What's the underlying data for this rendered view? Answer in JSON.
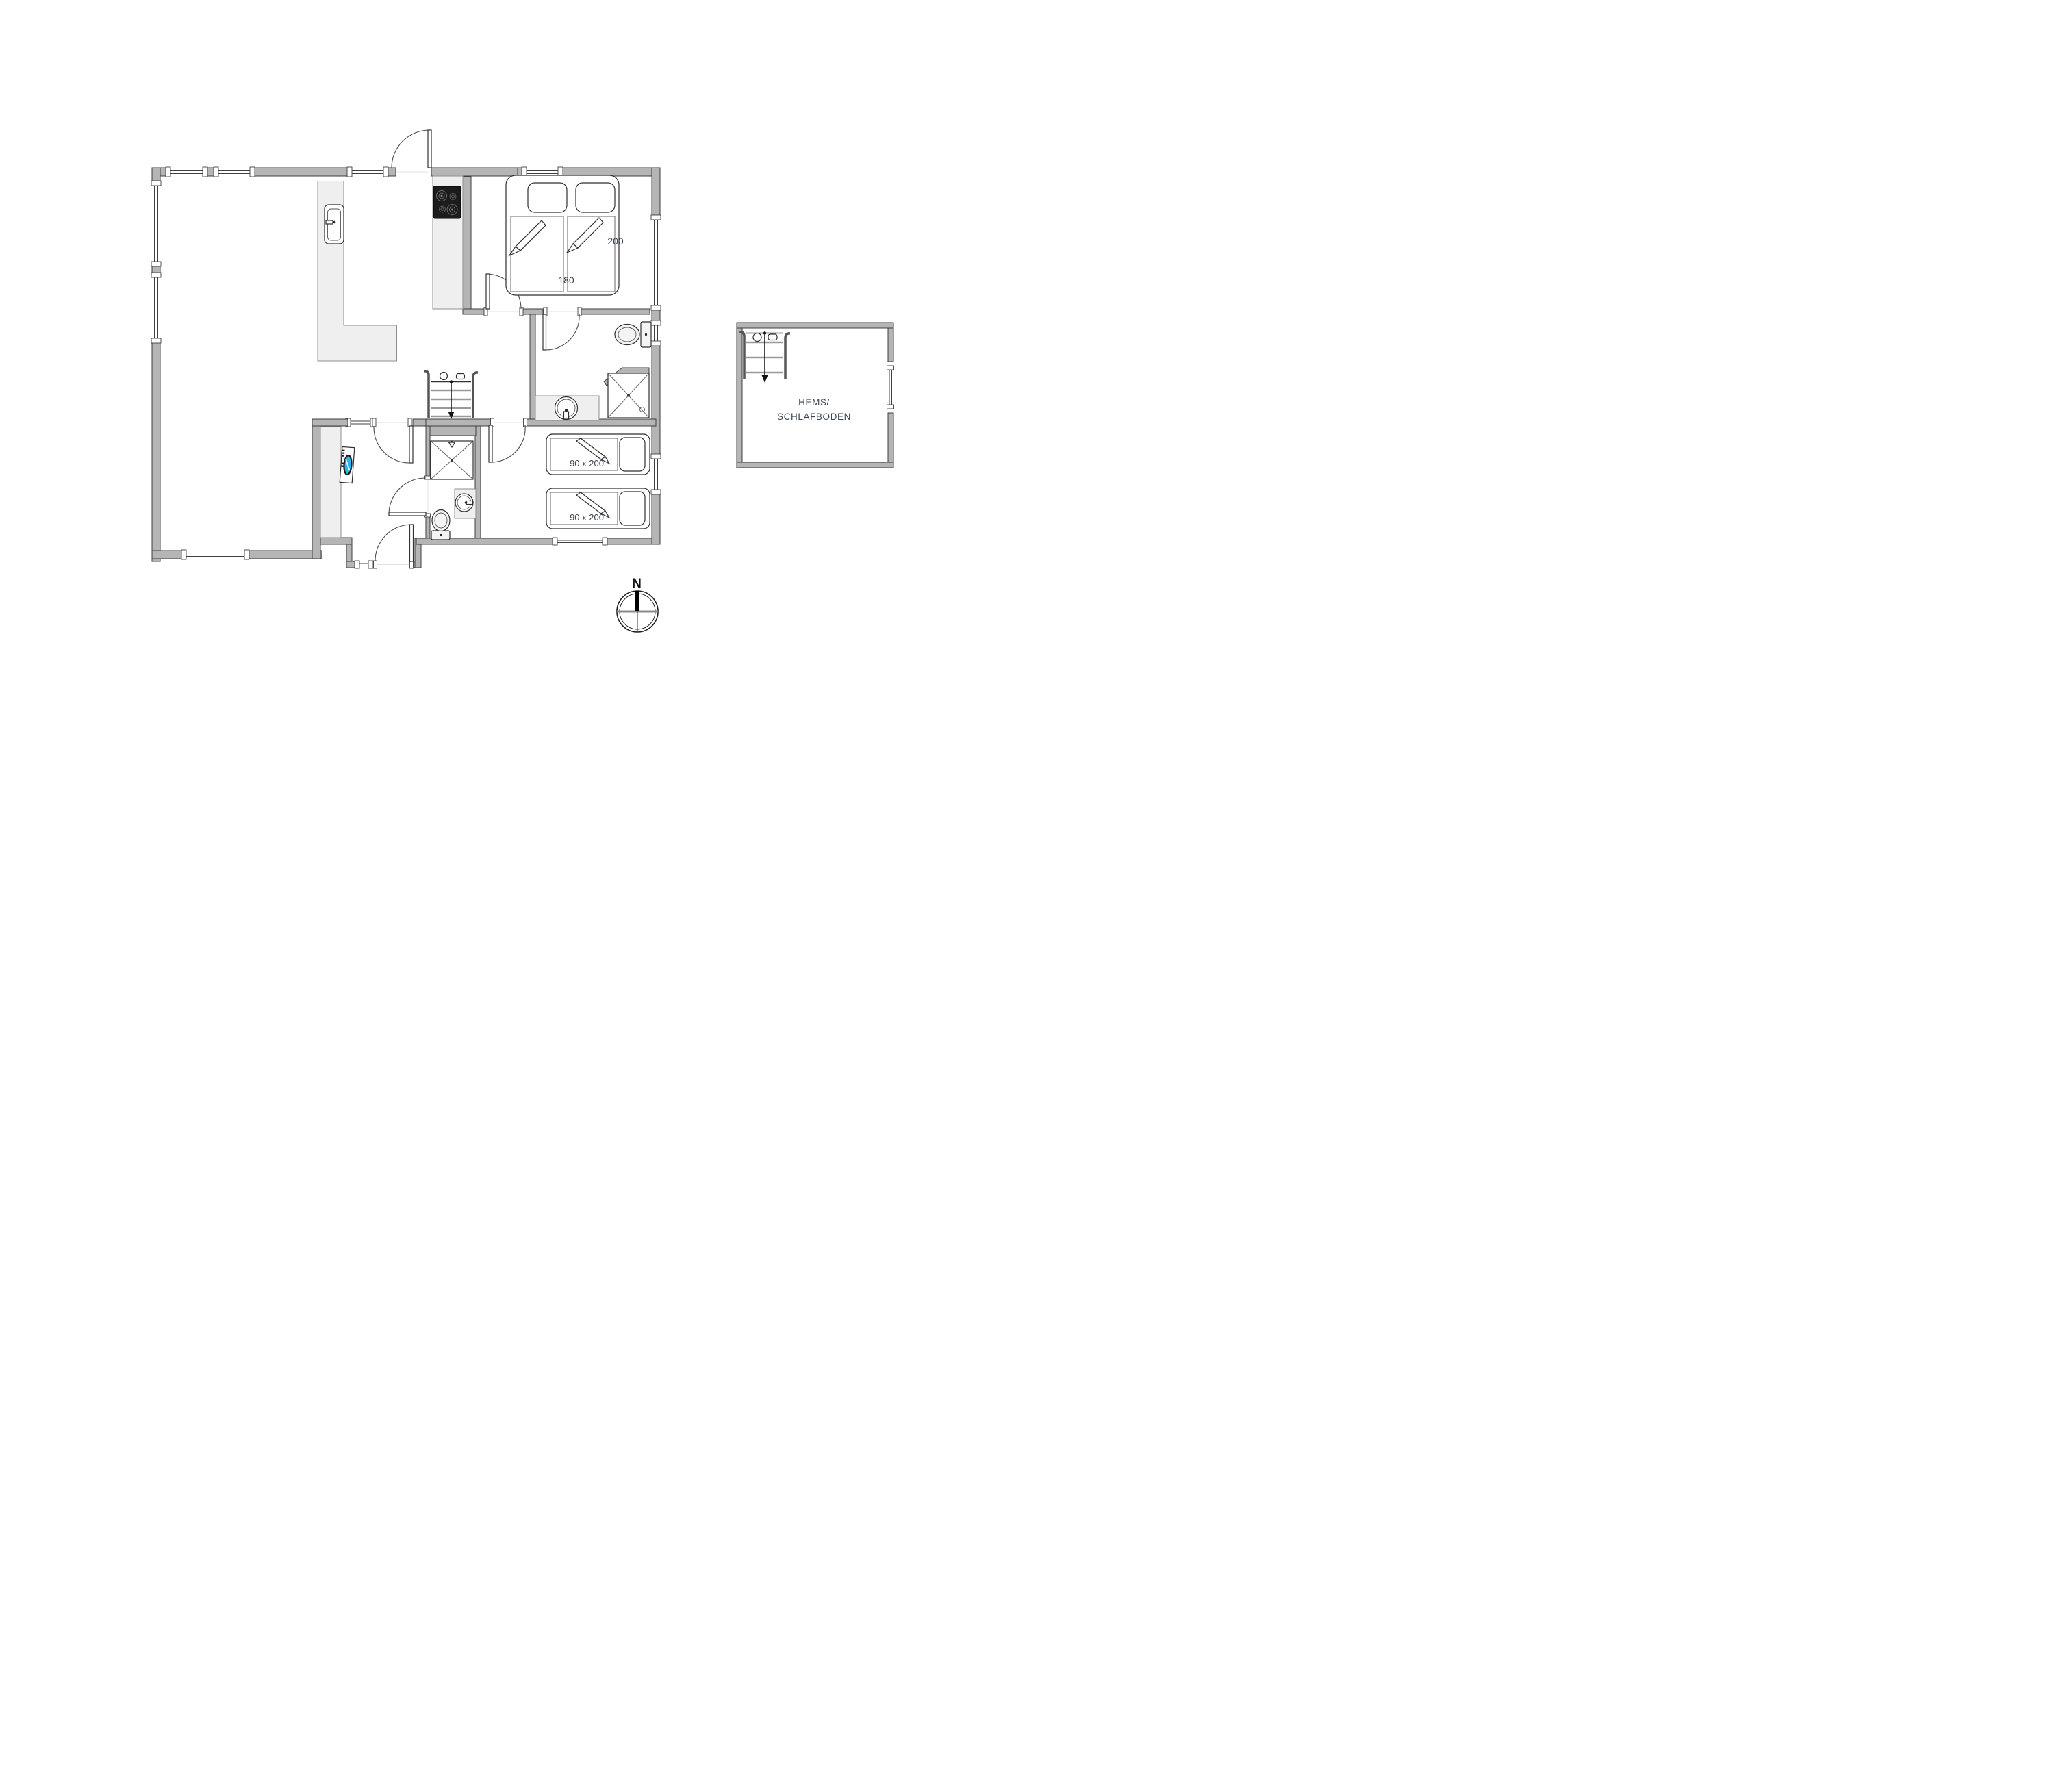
{
  "labels": {
    "double_bed_length": "200",
    "double_bed_width": "180",
    "single_bed_1": "90 x 200",
    "single_bed_2": "90 x 200",
    "loft_line1": "HEMS/",
    "loft_line2": "SCHLAFBODEN",
    "compass_north": "N"
  },
  "colors": {
    "wall": "#b5b5b5",
    "wall-outline": "#3f3f3f",
    "counter": "#efefef",
    "cooktop": "#1c1c1c",
    "washer-screen": "#2ab4e8",
    "dim-text": "#3a4553"
  }
}
